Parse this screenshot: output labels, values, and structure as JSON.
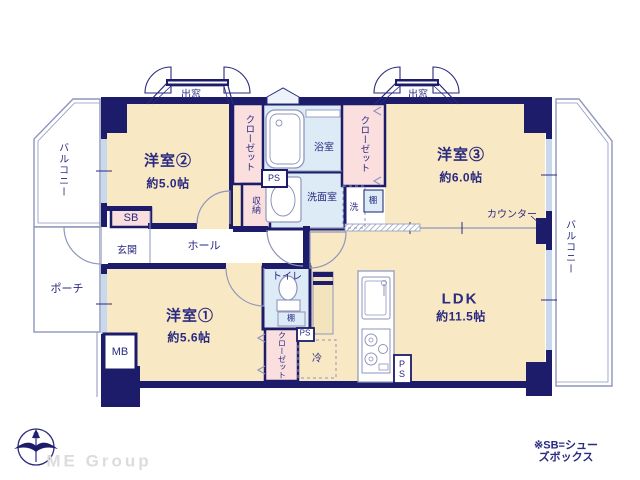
{
  "plan": {
    "labels": {
      "balcony": "バルコニー",
      "porch": "ポーチ",
      "entrance": "玄関",
      "hall": "ホール",
      "sb": "SB",
      "mb": "MB",
      "ps": "PS",
      "ps_stacked": "P\nS",
      "bay_window": "出窓",
      "closet": "クローゼット",
      "storage": "収納",
      "bathroom": "浴室",
      "washroom": "洗面室",
      "washer": "洗",
      "shelf": "棚",
      "toilet": "トイレ",
      "fridge": "冷",
      "counter": "カウンター",
      "north": "N"
    },
    "rooms": {
      "room1_name": "洋室①",
      "room1_size": "約5.6帖",
      "room2_name": "洋室②",
      "room2_size": "約5.0帖",
      "room3_name": "洋室③",
      "room3_size": "約6.0帖",
      "ldk_name": "LDK",
      "ldk_size": "約11.5帖"
    },
    "footer": {
      "brand": "ME Group",
      "note": "※SB=シューズボックス"
    },
    "colors": {
      "wall": "#1c1c6b",
      "floor_cream": "#f9e8c4",
      "wet_blue": "#dcebf6",
      "closet_pink": "#fadfde",
      "thin_line": "#8e96bb",
      "text_navy": "#2a2a80",
      "window_blue": "#c9d9ed",
      "logo_gray": "#dcdcdc"
    }
  }
}
